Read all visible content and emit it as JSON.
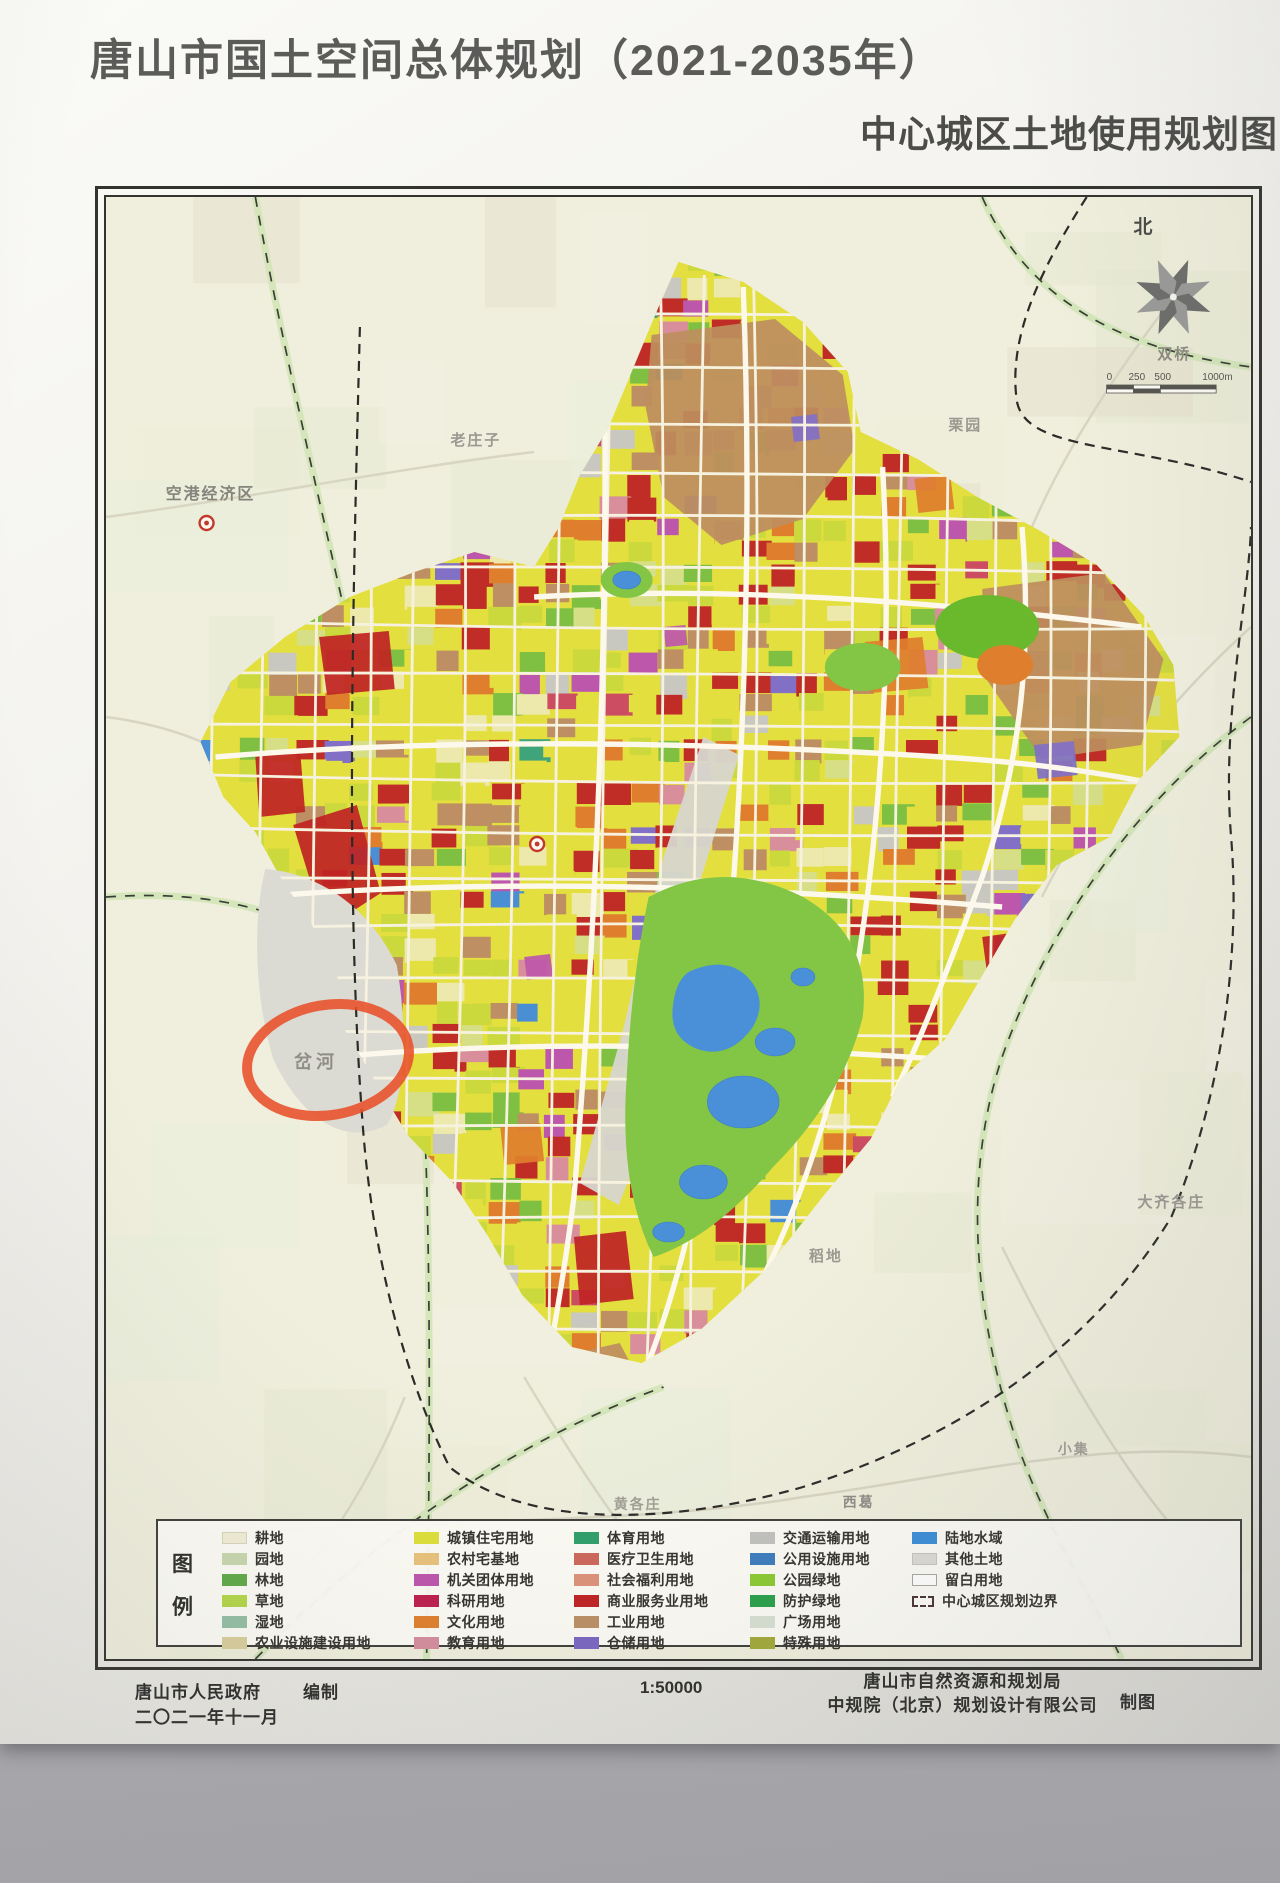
{
  "poster": {
    "title": "唐山市国土空间总体规划（2021-2035年）",
    "subtitle": "中心城区土地使用规划图"
  },
  "legend": {
    "title_chars": [
      "图",
      "例"
    ],
    "columns": [
      {
        "items": [
          {
            "label": "耕地",
            "color": "#f1eed6",
            "border": "#d9d6ba"
          },
          {
            "label": "园地",
            "color": "#c9d8ae"
          },
          {
            "label": "林地",
            "color": "#61aa48"
          },
          {
            "label": "草地",
            "color": "#b4d748"
          },
          {
            "label": "湿地",
            "color": "#93bfa4"
          },
          {
            "label": "农业设施建设用地",
            "color": "#d9cf9d"
          }
        ]
      },
      {
        "items": [
          {
            "label": "城镇住宅用地",
            "color": "#dde039"
          },
          {
            "label": "农村宅基地",
            "color": "#e9c27c"
          },
          {
            "label": "机关团体用地",
            "color": "#bd56ad"
          },
          {
            "label": "科研用地",
            "color": "#bd1e4e"
          },
          {
            "label": "文化用地",
            "color": "#e0802c"
          },
          {
            "label": "教育用地",
            "color": "#d68d9d"
          }
        ]
      },
      {
        "items": [
          {
            "label": "体育用地",
            "color": "#2fa06b"
          },
          {
            "label": "医疗卫生用地",
            "color": "#cc685a"
          },
          {
            "label": "社会福利用地",
            "color": "#dd9379"
          },
          {
            "label": "商业服务业用地",
            "color": "#bf2323"
          },
          {
            "label": "工业用地",
            "color": "#bb9066"
          },
          {
            "label": "仓储用地",
            "color": "#7a67c2"
          }
        ]
      },
      {
        "items": [
          {
            "label": "交通运输用地",
            "color": "#c2c2be"
          },
          {
            "label": "公用设施用地",
            "color": "#3d7dbd"
          },
          {
            "label": "公园绿地",
            "color": "#8ccb30"
          },
          {
            "label": "防护绿地",
            "color": "#28a14a"
          },
          {
            "label": "广场用地",
            "color": "#d7e0d2"
          },
          {
            "label": "特殊用地",
            "color": "#a2aa39"
          }
        ]
      },
      {
        "items": [
          {
            "label": "陆地水域",
            "color": "#3c8ed8"
          },
          {
            "label": "其他土地",
            "color": "#dcdbd5",
            "border": "#c6c5bf"
          },
          {
            "label": "留白用地",
            "color": "#ffffff",
            "border": "#a9a79f"
          },
          {
            "label": "中心城区规划边界",
            "type": "boundary"
          }
        ]
      }
    ]
  },
  "map": {
    "north_label": "北",
    "compass_color": "#6d6d6b",
    "scalebar": {
      "labels": [
        "0",
        "250",
        "500",
        "1000m"
      ]
    },
    "labels": [
      {
        "text": "老庄子",
        "x": 346,
        "y": 248,
        "size": 15,
        "color": "#9b9892"
      },
      {
        "text": "空港经济区",
        "x": 60,
        "y": 302,
        "size": 16,
        "color": "#85837b"
      },
      {
        "text": "栗园",
        "x": 846,
        "y": 233,
        "size": 15,
        "color": "#9b9892"
      },
      {
        "text": "双桥",
        "x": 1056,
        "y": 162,
        "size": 15,
        "color": "#8b897f"
      },
      {
        "text": "大齐各庄",
        "x": 1036,
        "y": 1010,
        "size": 15,
        "color": "#9b9892"
      },
      {
        "text": "稻地",
        "x": 706,
        "y": 1064,
        "size": 15,
        "color": "#9b9892"
      },
      {
        "text": "小集",
        "x": 956,
        "y": 1257,
        "size": 14,
        "color": "#a19e95"
      },
      {
        "text": "黄各庄",
        "x": 510,
        "y": 1312,
        "size": 14,
        "color": "#a19e95"
      },
      {
        "text": "西葛",
        "x": 740,
        "y": 1310,
        "size": 14,
        "color": "#8e8c84"
      }
    ],
    "annotation": {
      "text": "岔河",
      "text_color": "#8f8d86",
      "ellipse_color": "#e8502a",
      "cx": 223,
      "cy": 863,
      "rx": 82,
      "ry": 55,
      "rot": -10
    },
    "parcel_palette": [
      {
        "color": "#e3df3e",
        "w": 45
      },
      {
        "color": "#ccd93c",
        "w": 10
      },
      {
        "color": "#bf2d26",
        "w": 9
      },
      {
        "color": "#bd8f62",
        "w": 8
      },
      {
        "color": "#7fc043",
        "w": 6
      },
      {
        "color": "#df7e2d",
        "w": 5
      },
      {
        "color": "#ede9ad",
        "w": 5
      },
      {
        "color": "#d6df85",
        "w": 3
      },
      {
        "color": "#d98f9b",
        "w": 2
      },
      {
        "color": "#cc4c62",
        "w": 1.5
      },
      {
        "color": "#bd57ab",
        "w": 1.5
      },
      {
        "color": "#8170c6",
        "w": 1.5
      },
      {
        "color": "#c9c8c0",
        "w": 1.5
      },
      {
        "color": "#4a8fd3",
        "w": 1
      },
      {
        "color": "#3fa47a",
        "w": 0.5
      }
    ],
    "water_color": "#4a90d9",
    "park_color": "#83c544",
    "industry_color": "#bd8e5f",
    "void_color": "#dbdad3"
  },
  "credits": {
    "publisher": "唐山市人民政府",
    "publisher_role": "编制",
    "date": "二〇二一年十一月",
    "scale_text": "1:50000",
    "agency_line1": "唐山市自然资源和规划局",
    "agency_line2": "中规院（北京）规划设计有限公司",
    "agency_role": "制图"
  }
}
